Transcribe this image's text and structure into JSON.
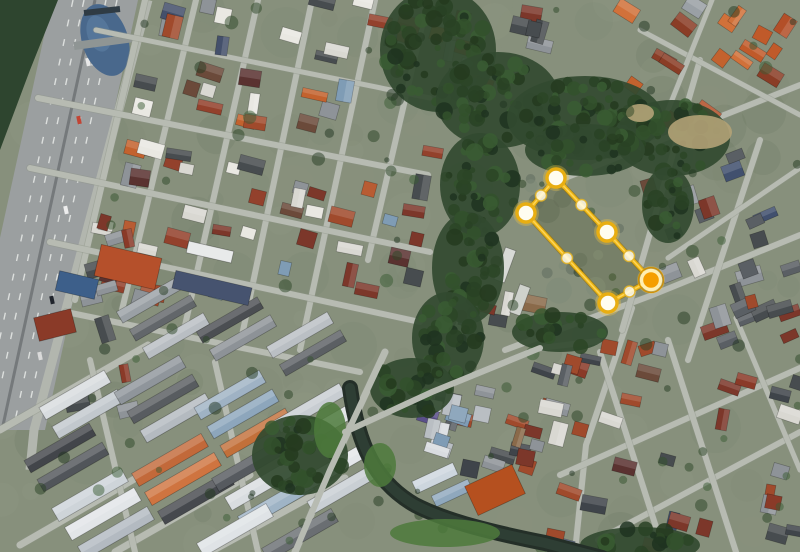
{
  "view": {
    "type": "satellite-imagery",
    "width": 800,
    "height": 552
  },
  "palette": {
    "ground": "#87907c",
    "street": "#b7bbb2",
    "street_shadow": "#8f9588",
    "highway": "#9b9fa0",
    "highway_median": "#75797b",
    "highway_dash": "#e8eae8",
    "side_road": "#b2b6ae",
    "pond": "#49688c",
    "pond_light": "#5e80a4",
    "canal": "#242f28",
    "canal_core": "#2e3e34",
    "forest": "#2e452f",
    "lot": "#707c6e",
    "sand": "#b3a277",
    "grass_bright": "#4d7a3c",
    "tree_tones": [
      "#24391f",
      "#2c4526",
      "#33512c",
      "#1f3320",
      "#3a5c33",
      "#294224"
    ],
    "mottle_tones": [
      "#79836d",
      "#6d7a64",
      "#8a8f7d",
      "#9aa08c",
      "#75806e",
      "#55624e",
      "#8f967f"
    ]
  },
  "overlay": {
    "fill": "rgba(255,214,0,0.05)",
    "stroke_outer": "#9a7100",
    "stroke_main": "#ecb412",
    "stroke_core": "#ffd75e",
    "vertex_fill": "#fffdf0",
    "vertex_ring": "#e8ae12",
    "vertex_glow": "rgba(255,204,61,0.30)",
    "selected_fill": "#f59e00",
    "selected_ring": "#ffeeb2",
    "midpoint_fill": "rgba(255,252,235,0.85)",
    "midpoint_ring": "rgba(226,178,34,0.85)",
    "vertices": [
      {
        "x": 556,
        "y": 178
      },
      {
        "x": 607,
        "y": 232
      },
      {
        "x": 651,
        "y": 280,
        "selected": true
      },
      {
        "x": 608,
        "y": 303
      },
      {
        "x": 526,
        "y": 213
      }
    ]
  },
  "scene": {
    "texture": {
      "seed": 5,
      "count": 160,
      "rmin": 8,
      "rmax": 26,
      "opacity": 0.13
    },
    "global_trees": {
      "seed": 9,
      "count": 120,
      "rmin": 2.5,
      "rmax": 7,
      "opacity": 0.5
    },
    "forest_corner": [
      [
        0,
        0
      ],
      [
        58,
        0
      ],
      [
        30,
        70
      ],
      [
        0,
        150
      ]
    ],
    "pond": {
      "cx": 105,
      "cy": 40,
      "rx": 23,
      "ry": 37,
      "rot": -18
    },
    "pond_bridges": [
      {
        "pts": [
          [
            74,
            46
          ],
          [
            134,
            38
          ]
        ],
        "w": 8,
        "color": "#8f9594"
      },
      {
        "pts": [
          [
            84,
            13
          ],
          [
            120,
            9
          ]
        ],
        "w": 6,
        "color": "#2f3b44"
      }
    ],
    "highway": {
      "quad": [
        [
          52,
          0
        ],
        [
          138,
          0
        ],
        [
          45,
          430
        ],
        [
          -42,
          430
        ]
      ],
      "median": {
        "pts": [
          [
            95,
            0
          ],
          [
            2,
            430
          ]
        ],
        "w": 3
      },
      "dashes": [
        {
          "pts": [
            [
              73,
              0
            ],
            [
              -20,
              430
            ]
          ]
        },
        {
          "pts": [
            [
              117,
              0
            ],
            [
              24,
              430
            ]
          ]
        },
        {
          "pts": [
            [
              84,
              0
            ],
            [
              -9,
              430
            ]
          ]
        },
        {
          "pts": [
            [
              106,
              0
            ],
            [
              13,
              430
            ]
          ]
        }
      ],
      "side_road": {
        "pts": [
          [
            148,
            0
          ],
          [
            34,
            430
          ],
          [
            30,
            470
          ]
        ],
        "w": 9
      }
    },
    "vehicles": [
      [
        88,
        62,
        "#e8e8e8"
      ],
      [
        79,
        120,
        "#c24434"
      ],
      [
        66,
        210,
        "#ededed"
      ],
      [
        52,
        300,
        "#20242c"
      ],
      [
        97,
        36,
        "#c8ccd0"
      ],
      [
        40,
        356,
        "#dadada"
      ]
    ],
    "streets": [
      {
        "pts": [
          [
            145,
            0
          ],
          [
            75,
            300
          ]
        ],
        "w": 6
      },
      {
        "pts": [
          [
            196,
            0
          ],
          [
            122,
            310
          ]
        ],
        "w": 6
      },
      {
        "pts": [
          [
            258,
            0
          ],
          [
            184,
            330
          ]
        ],
        "w": 6
      },
      {
        "pts": [
          [
            312,
            0
          ],
          [
            240,
            345
          ]
        ],
        "w": 6
      },
      {
        "pts": [
          [
            375,
            0
          ],
          [
            300,
            350
          ]
        ],
        "w": 6
      },
      {
        "pts": [
          [
            428,
            0
          ],
          [
            368,
            260
          ]
        ],
        "w": 6
      },
      {
        "pts": [
          [
            38,
            98
          ],
          [
            428,
            175
          ]
        ],
        "w": 6
      },
      {
        "pts": [
          [
            30,
            168
          ],
          [
            430,
            252
          ]
        ],
        "w": 6
      },
      {
        "pts": [
          [
            50,
            242
          ],
          [
            420,
            322
          ]
        ],
        "w": 6
      },
      {
        "pts": [
          [
            66,
            312
          ],
          [
            360,
            372
          ]
        ],
        "w": 6
      },
      {
        "pts": [
          [
            96,
            30
          ],
          [
            430,
            98
          ]
        ],
        "w": 5
      },
      {
        "pts": [
          [
            0,
            430
          ],
          [
            148,
            345
          ]
        ],
        "w": 7
      },
      {
        "pts": [
          [
            20,
            545
          ],
          [
            150,
            470
          ]
        ],
        "w": 7
      },
      {
        "pts": [
          [
            115,
            552
          ],
          [
            250,
            475
          ]
        ],
        "w": 7
      },
      {
        "pts": [
          [
            210,
            552
          ],
          [
            345,
            478
          ]
        ],
        "w": 7
      },
      {
        "pts": [
          [
            90,
            360
          ],
          [
            135,
            552
          ]
        ],
        "w": 6
      },
      {
        "pts": [
          [
            215,
            362
          ],
          [
            258,
            552
          ]
        ],
        "w": 6
      },
      {
        "pts": [
          [
            385,
            352
          ],
          [
            330,
            470
          ],
          [
            295,
            552
          ]
        ],
        "w": 7
      },
      {
        "pts": [
          [
            345,
            432
          ],
          [
            432,
            392
          ],
          [
            540,
            348
          ],
          [
            598,
            341
          ]
        ],
        "w": 6
      },
      {
        "pts": [
          [
            505,
            350
          ],
          [
            650,
            296
          ],
          [
            800,
            235
          ]
        ],
        "w": 6
      },
      {
        "pts": [
          [
            632,
            308
          ],
          [
            586,
            445
          ],
          [
            575,
            552
          ]
        ],
        "w": 6
      },
      {
        "pts": [
          [
            700,
            60
          ],
          [
            622,
            330
          ]
        ],
        "w": 6
      },
      {
        "pts": [
          [
            760,
            140
          ],
          [
            688,
            360
          ]
        ],
        "w": 6
      },
      {
        "pts": [
          [
            560,
            180
          ],
          [
            800,
            85
          ]
        ],
        "w": 6
      },
      {
        "pts": [
          [
            668,
            258
          ],
          [
            800,
            168
          ]
        ],
        "w": 5
      },
      {
        "pts": [
          [
            560,
            475
          ],
          [
            800,
            368
          ]
        ],
        "w": 6
      },
      {
        "pts": [
          [
            598,
            540
          ],
          [
            800,
            432
          ]
        ],
        "w": 6
      },
      {
        "pts": [
          [
            600,
            352
          ],
          [
            664,
            552
          ]
        ],
        "w": 6
      },
      {
        "pts": [
          [
            668,
            340
          ],
          [
            736,
            552
          ]
        ],
        "w": 6
      },
      {
        "pts": [
          [
            736,
            318
          ],
          [
            800,
            470
          ]
        ],
        "w": 5
      },
      {
        "pts": [
          [
            640,
            30
          ],
          [
            800,
            115
          ]
        ],
        "w": 5
      },
      {
        "pts": [
          [
            712,
            0
          ],
          [
            662,
            125
          ]
        ],
        "w": 5
      }
    ],
    "blocks": [
      {
        "bbox": [
          40,
          0,
          395,
          300
        ],
        "n": 165,
        "angle": 13,
        "seed": 7,
        "palette": [
          "#7c372a",
          "#7c372a",
          "#a04a2c",
          "#c3622e",
          "#6b4a3a",
          "#474c4f",
          "#474c4f",
          "#8e9398",
          "#d9d8d2",
          "#44506b",
          "#7f9cb5",
          "#e9e8e2",
          "#93412c",
          "#5a3230",
          "#b85c33"
        ]
      },
      {
        "bbox": [
          40,
          160,
          100,
          260
        ],
        "n": 26,
        "angle": -14,
        "seed": 11,
        "palette": [
          "#8e9398",
          "#b9bec3",
          "#d9d8d2",
          "#8a3a28",
          "#474c4f",
          "#6f747a",
          "#a04a2c"
        ]
      },
      {
        "bbox": [
          625,
          0,
          175,
          125
        ],
        "n": 30,
        "angle": 33,
        "seed": 21,
        "palette": [
          "#c05a2a",
          "#b34f28",
          "#d1713a",
          "#8a3d26",
          "#c3622e",
          "#9aa0a5",
          "#7c372a"
        ]
      },
      {
        "bbox": [
          645,
          130,
          155,
          225
        ],
        "n": 42,
        "angle": -20,
        "seed": 31,
        "palette": [
          "#5a5f64",
          "#474c4f",
          "#8e9398",
          "#7c372a",
          "#a04a2c",
          "#d9d8d2",
          "#41506e",
          "#6b4a3a"
        ]
      },
      {
        "bbox": [
          555,
          345,
          245,
          207
        ],
        "n": 60,
        "angle": 15,
        "seed": 41,
        "palette": [
          "#7c372a",
          "#8a3a28",
          "#474c4f",
          "#5a3230",
          "#a04a2c",
          "#8e9398",
          "#d9d8d2",
          "#44506b",
          "#6b4a3a",
          "#3f444a"
        ]
      },
      {
        "bbox": [
          445,
          295,
          180,
          175
        ],
        "n": 45,
        "angle": 15,
        "seed": 51,
        "palette": [
          "#474c4f",
          "#5a5f64",
          "#7c372a",
          "#8e9398",
          "#a04a2c",
          "#d9d8d2",
          "#3f444a",
          "#8a6a4a"
        ]
      },
      {
        "bbox": [
          388,
          392,
          95,
          60
        ],
        "n": 12,
        "angle": 15,
        "seed": 61,
        "palette": [
          "#8fa8bd",
          "#6b7db5",
          "#5a4f8a",
          "#d9dce0",
          "#b9bec3",
          "#7f9cb5"
        ]
      },
      {
        "bbox": [
          436,
          0,
          125,
          85
        ],
        "n": 14,
        "angle": 13,
        "seed": 71,
        "palette": [
          "#7c372a",
          "#a04a2c",
          "#474c4f",
          "#8e9398",
          "#c3622e"
        ]
      }
    ],
    "strips": [
      [
        150,
        300,
        70,
        13,
        -30,
        "#9aa0a5"
      ],
      [
        163,
        318,
        70,
        13,
        -30,
        "#62666a"
      ],
      [
        176,
        336,
        70,
        13,
        -30,
        "#b9bec3"
      ],
      [
        230,
        320,
        70,
        13,
        -30,
        "#4b4e52"
      ],
      [
        243,
        338,
        70,
        13,
        -30,
        "#8d9297"
      ],
      [
        300,
        335,
        70,
        13,
        -30,
        "#babfc4"
      ],
      [
        313,
        353,
        70,
        13,
        -30,
        "#5b5f63"
      ],
      [
        75,
        395,
        75,
        14,
        -30,
        "#d8dcdf"
      ],
      [
        88,
        414,
        75,
        14,
        -30,
        "#c2c8cd"
      ],
      [
        60,
        448,
        75,
        14,
        -30,
        "#42454a"
      ],
      [
        73,
        467,
        75,
        14,
        -30,
        "#51555a"
      ],
      [
        150,
        380,
        75,
        14,
        -30,
        "#8f959b"
      ],
      [
        163,
        399,
        75,
        14,
        -30,
        "#585c60"
      ],
      [
        176,
        418,
        75,
        14,
        -30,
        "#b4bac0"
      ],
      [
        230,
        395,
        75,
        14,
        -30,
        "#9fb2c4"
      ],
      [
        243,
        414,
        75,
        14,
        -30,
        "#8da6bc"
      ],
      [
        256,
        433,
        75,
        14,
        -30,
        "#c2703a"
      ],
      [
        310,
        408,
        75,
        14,
        -30,
        "#c8cdd2"
      ],
      [
        323,
        427,
        75,
        14,
        -30,
        "#dfe2e5"
      ],
      [
        90,
        495,
        80,
        15,
        -30,
        "#ced4d9"
      ],
      [
        103,
        514,
        80,
        15,
        -30,
        "#e2e5e8"
      ],
      [
        116,
        533,
        80,
        15,
        -30,
        "#b3bac1"
      ],
      [
        170,
        460,
        80,
        15,
        -30,
        "#c2693a"
      ],
      [
        183,
        479,
        80,
        15,
        -30,
        "#cf7440"
      ],
      [
        196,
        498,
        80,
        15,
        -30,
        "#46494e"
      ],
      [
        250,
        465,
        80,
        15,
        -30,
        "#565a5f"
      ],
      [
        263,
        484,
        80,
        15,
        -30,
        "#d9dde0"
      ],
      [
        276,
        503,
        80,
        15,
        -30,
        "#9fb4c6"
      ],
      [
        330,
        470,
        75,
        14,
        -30,
        "#e4e7ea"
      ],
      [
        343,
        489,
        75,
        14,
        -30,
        "#c9cfd4"
      ],
      [
        235,
        530,
        80,
        15,
        -30,
        "#dfe3e6"
      ],
      [
        300,
        535,
        80,
        15,
        -30,
        "#6a6e72"
      ],
      [
        435,
        478,
        45,
        13,
        -25,
        "#cdd6de"
      ],
      [
        452,
        493,
        40,
        12,
        -25,
        "#8fa8bd"
      ]
    ],
    "landmarks": [
      [
        128,
        267,
        62,
        32,
        13,
        "#b5502b"
      ],
      [
        77,
        285,
        40,
        20,
        13,
        "#3d5f8a"
      ],
      [
        212,
        288,
        78,
        18,
        13,
        "#46536f"
      ],
      [
        210,
        252,
        46,
        12,
        13,
        "#e8eaea"
      ],
      [
        495,
        490,
        52,
        32,
        -25,
        "#b5501f"
      ],
      [
        55,
        325,
        38,
        24,
        -14,
        "#8a3a28"
      ],
      [
        505,
        265,
        34,
        11,
        -70,
        "#d8dad6"
      ],
      [
        520,
        300,
        30,
        11,
        -70,
        "#cfd2cc"
      ]
    ],
    "river_ellipses": [
      [
        438,
        50,
        58,
        62
      ],
      [
        498,
        100,
        62,
        48
      ],
      [
        585,
        118,
        78,
        42
      ],
      [
        672,
        138,
        58,
        38
      ],
      [
        585,
        150,
        60,
        26
      ],
      [
        480,
        185,
        40,
        52
      ],
      [
        468,
        268,
        36,
        56
      ],
      [
        448,
        338,
        36,
        46
      ],
      [
        412,
        388,
        42,
        30
      ],
      [
        668,
        205,
        26,
        38
      ],
      [
        560,
        332,
        48,
        20
      ],
      [
        640,
        545,
        60,
        18
      ],
      [
        300,
        455,
        48,
        40
      ]
    ],
    "sand_patches": [
      [
        700,
        132,
        32,
        17
      ],
      [
        640,
        113,
        14,
        9
      ]
    ],
    "canal": {
      "path": "M 350,388 C 358,445 375,482 415,505 C 448,522 495,533 545,543 L 602,558",
      "w_outer": 16,
      "w_inner": 10
    },
    "grass_banks": [
      [
        445,
        533,
        55,
        14
      ],
      [
        380,
        465,
        16,
        22
      ],
      [
        330,
        430,
        16,
        28
      ]
    ],
    "lot_mottle": {
      "seed": 13,
      "count": 14
    }
  }
}
